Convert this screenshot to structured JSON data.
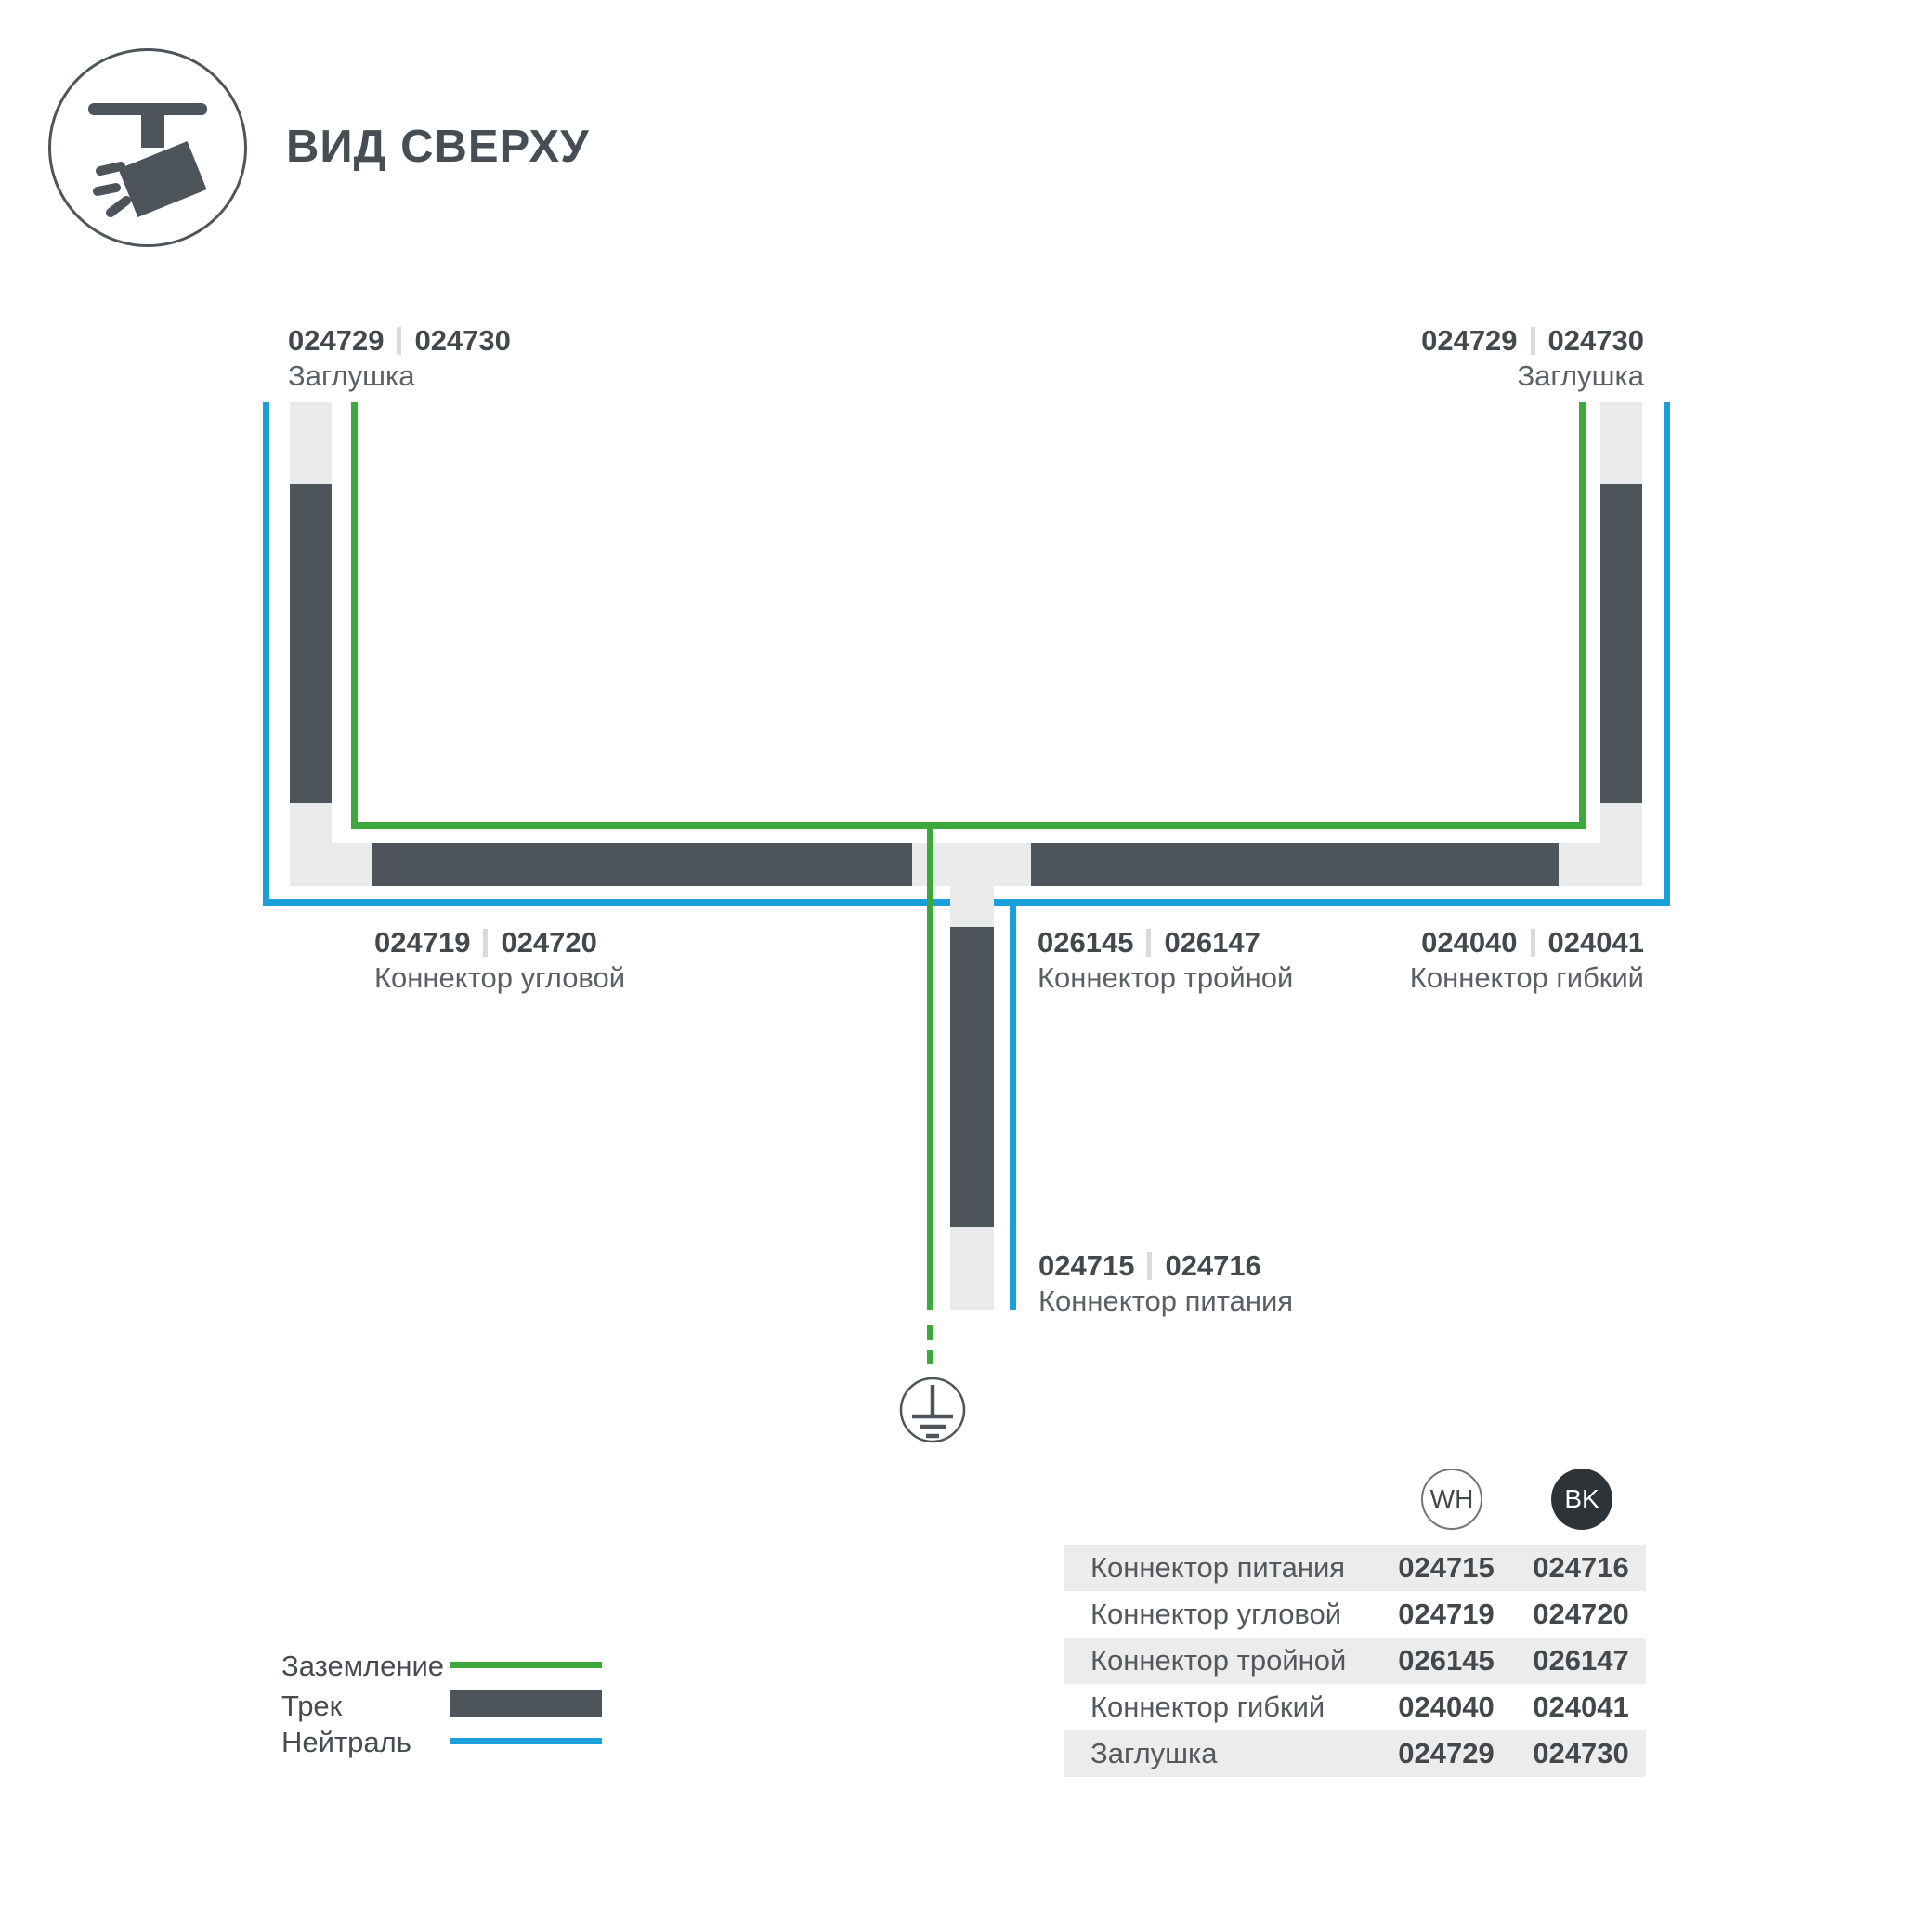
{
  "header": {
    "title": "ВИД СВЕРХУ"
  },
  "colors": {
    "track": "#4d555b",
    "connector": "#e9ebeb",
    "ground_green": "#3fa83c",
    "neutral_blue": "#1ba0dc",
    "text_dark": "#43484c",
    "text_gray": "#5a6065",
    "table_row_gray": "#ececec",
    "bk_circle": "#2e3338"
  },
  "labels": {
    "cap_left": {
      "code_wh": "024729",
      "code_bk": "024730",
      "name": "Заглушка"
    },
    "cap_right": {
      "code_wh": "024729",
      "code_bk": "024730",
      "name": "Заглушка"
    },
    "corner": {
      "code_wh": "024719",
      "code_bk": "024720",
      "name": "Коннектор угловой"
    },
    "triple": {
      "code_wh": "026145",
      "code_bk": "026147",
      "name": "Коннектор тройной"
    },
    "flex": {
      "code_wh": "024040",
      "code_bk": "024041",
      "name": "Коннектор гибкий"
    },
    "power": {
      "code_wh": "024715",
      "code_bk": "024716",
      "name": "Коннектор питания"
    }
  },
  "legend": {
    "items": [
      {
        "label": "Заземление",
        "swatch": "ground-green-line"
      },
      {
        "label": "Трек",
        "swatch": "track-dark-bar"
      },
      {
        "label": "Нейтраль",
        "swatch": "neutral-blue-line"
      }
    ]
  },
  "table": {
    "col_wh": "WH",
    "col_bk": "BK",
    "rows": [
      {
        "name": "Коннектор питания",
        "wh": "024715",
        "bk": "024716"
      },
      {
        "name": "Коннектор угловой",
        "wh": "024719",
        "bk": "024720"
      },
      {
        "name": "Коннектор тройной",
        "wh": "026145",
        "bk": "026147"
      },
      {
        "name": "Коннектор гибкий",
        "wh": "024040",
        "bk": "024041"
      },
      {
        "name": "Заглушка",
        "wh": "024729",
        "bk": "024730"
      }
    ]
  }
}
